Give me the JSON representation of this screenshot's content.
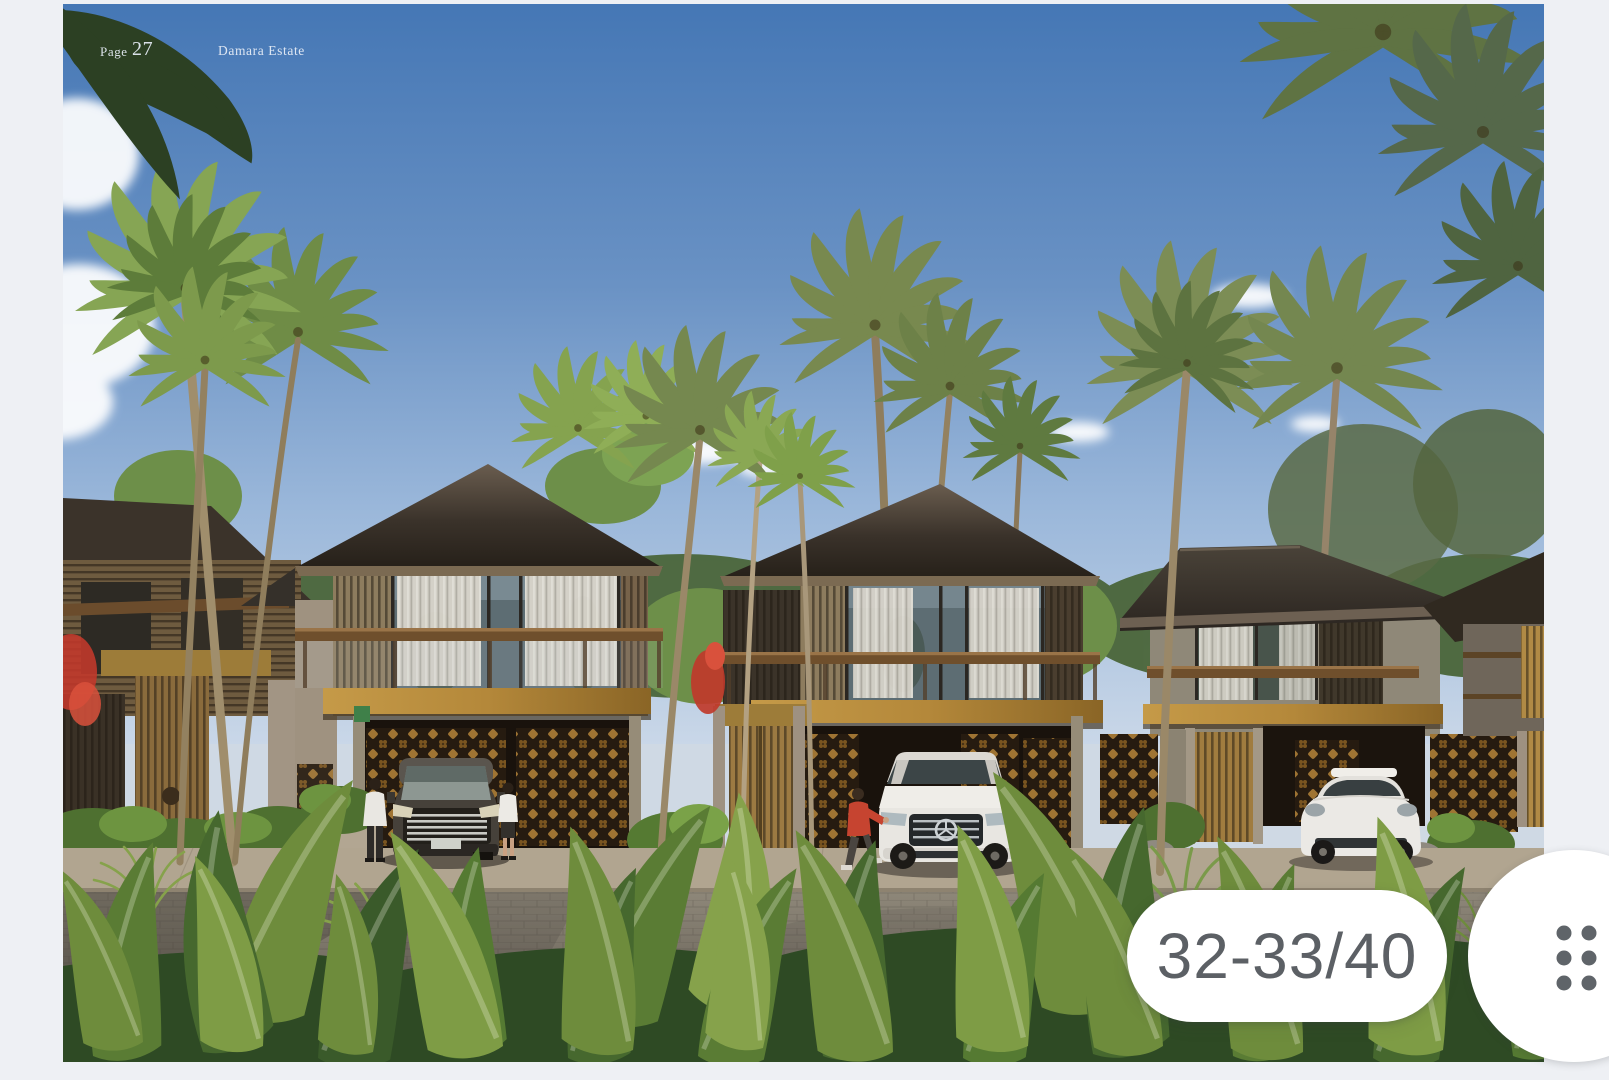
{
  "photo_overlay": {
    "page_label": "Page",
    "page_number": "27",
    "brochure_title": "Damara Estate"
  },
  "pagination": {
    "indicator": "32-33/40",
    "total_pages": "40",
    "visible_spread": "32-33"
  },
  "buttons": {
    "drag_handle": "six-dot drag handle"
  },
  "colors": {
    "canvas_bg": "#eef0f4",
    "pill_bg": "#ffffff",
    "pill_text": "#5c6065",
    "handle_dots": "#5f6469",
    "sky_top": "#4577b5",
    "sky_horizon": "#c9d7e8",
    "roof": "#3a322a",
    "gold_accent": "#b4883a",
    "foliage": "#6e8c3c",
    "road": "#7d776c"
  },
  "image": {
    "description": "Architectural rendering of Damara Estate: a row of modern two-storey tropical villas with dark hip roofs, timber slat screens, carved golden breeze-block garage walls, coconut palms, a dark luxury van, a white Mercedes SUV and a white Porsche parked in front, people on the driveway and lush green plants bordering a paved street under a blue sky."
  }
}
